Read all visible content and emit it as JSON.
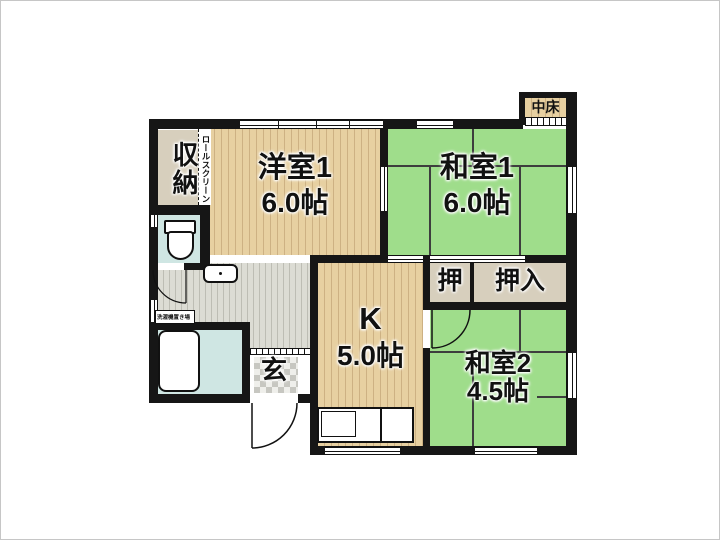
{
  "plan": {
    "rooms": {
      "shuno": "収納",
      "rollscreen": "ロールスクリーン",
      "yoshitsu1_name": "洋室1",
      "yoshitsu1_size": "6.0帖",
      "washitsu1_name": "和室1",
      "washitsu1_size": "6.0帖",
      "nakadoko": "中床",
      "oshi": "押",
      "oshiire": "押入",
      "kitchen_name": "K",
      "kitchen_size": "5.0帖",
      "washitsu2_name": "和室2",
      "washitsu2_size": "4.5帖",
      "genkan": "玄",
      "laundry": "洗濯機置き場"
    },
    "colors": {
      "wall": "#161616",
      "tatami_green": "#9fdd8b",
      "wood_floor": "#e7d0a1",
      "closet_tan": "#d7cfbd",
      "water_blue": "#cfe6e3",
      "hall_gray": "#dcdcd4"
    }
  }
}
